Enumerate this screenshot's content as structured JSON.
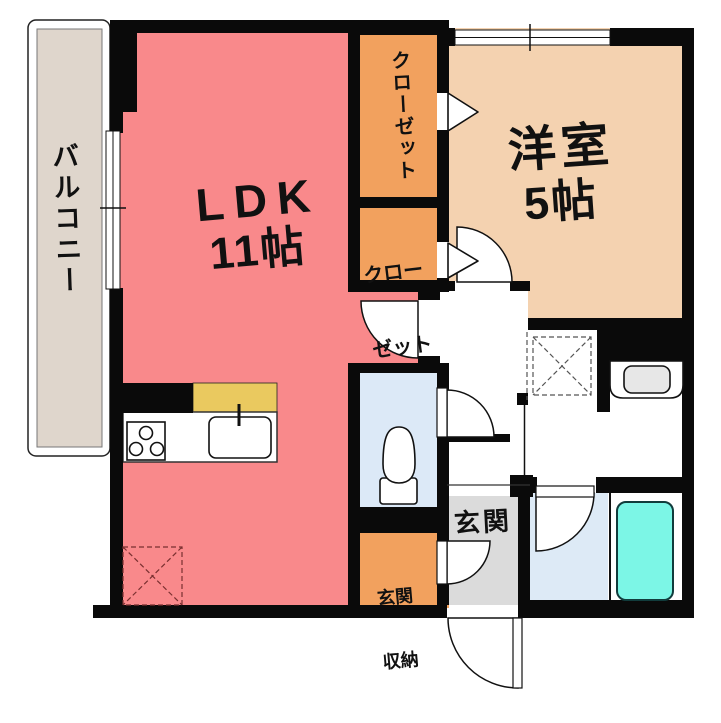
{
  "floorplan": {
    "labels": {
      "balcony": "バルコニー",
      "ldk": "LDK",
      "ldk_size": "11帖",
      "western_room": "洋室",
      "western_room_size": "5帖",
      "closet_top": "クローゼット",
      "closet_lower_line1": "クロー",
      "closet_lower_line2": "ゼット",
      "entrance": "玄関",
      "entrance_storage_line1": "玄関",
      "entrance_storage_line2": "収納"
    },
    "colors": {
      "wall": "#0A0A0A",
      "ldk": "#F9898B",
      "western_room": "#F4D2B0",
      "closet": "#F2A15E",
      "entrance_storage": "#F2A15E",
      "balcony": "#DFD6CC",
      "toilet_room": "#DCE9F7",
      "bathroom": "#DDEAF6",
      "bathtub": "#7CF6E6",
      "entrance": "#DBDBDB",
      "kitchen_counter_top": "#EAC95F",
      "fridge_dash": "#7A3030"
    },
    "fixtures": {
      "kitchen_stove": "gas-stove-3-burners",
      "kitchen_sink": "kitchen-sink-with-faucet",
      "toilet": "toilet-bowl-and-tank",
      "washbasin": "vanity-washbasin",
      "bathtub": "bathtub",
      "washing_machine_space": "dashed-square-x",
      "refrigerator_space": "dashed-square-x",
      "windows": "double-line-windows",
      "doors": "quarter-arc-swing-doors",
      "closet_doors": "triangle-direction-markers"
    }
  }
}
